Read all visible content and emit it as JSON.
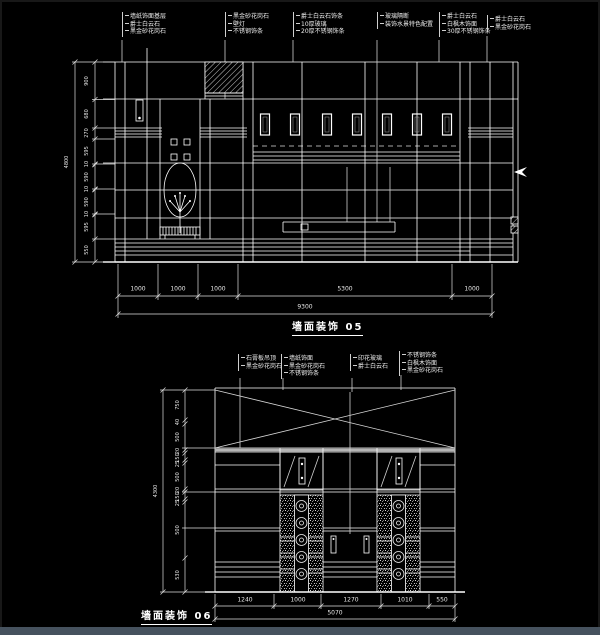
{
  "colors": {
    "background": "#000000",
    "line": "#ffffff",
    "bottom_bar": "#46525e"
  },
  "drawing1": {
    "title": "墙面装饰 05",
    "material_labels": [
      {
        "lines": [
          "墙纸饰面基层",
          "爵士白云石",
          "黑金砂花岗石"
        ]
      },
      {
        "lines": [
          "黑金砂花岗石",
          "壁灯",
          "不锈钢饰条"
        ]
      },
      {
        "lines": [
          "爵士白云石饰条",
          "10厚玻璃",
          "20厚不锈钢饰条"
        ]
      },
      {
        "lines": [
          "玻璃隔断",
          "装饰水景特色配置"
        ]
      },
      {
        "lines": [
          "爵士白云石",
          "白枫木饰面",
          "30厚不锈钢饰条"
        ]
      },
      {
        "lines": [
          "爵士白云石",
          "黑金砂花岗石"
        ]
      }
    ],
    "bottom_dims": [
      "1000",
      "1000",
      "1000",
      "5300",
      "1000"
    ],
    "bottom_total": "9300",
    "left_dims": [
      "900",
      "680",
      "270",
      "595",
      "10",
      "590",
      "10",
      "590",
      "10",
      "595",
      "550"
    ],
    "left_total": "4800"
  },
  "drawing2": {
    "title": "墙面装饰 06",
    "material_labels": [
      {
        "lines": [
          "石膏板吊顶",
          "黑金砂花岗石"
        ]
      },
      {
        "lines": [
          "墙纸饰面",
          "黑金砂花岗石",
          "不锈钢饰条"
        ]
      },
      {
        "lines": [
          "印花玻璃",
          "爵士白云石"
        ]
      },
      {
        "lines": [
          "不锈钢饰条",
          "白枫木饰面",
          "黑金砂花岗石"
        ]
      }
    ],
    "bottom_dims": [
      "1240",
      "1000",
      "1270",
      "1010",
      "550"
    ],
    "bottom_total": "5070",
    "left_dims": [
      "750",
      "40",
      "500",
      "20",
      "150",
      "25",
      "500",
      "20",
      "150",
      "25",
      "500",
      "530"
    ],
    "left_total": "4300"
  }
}
